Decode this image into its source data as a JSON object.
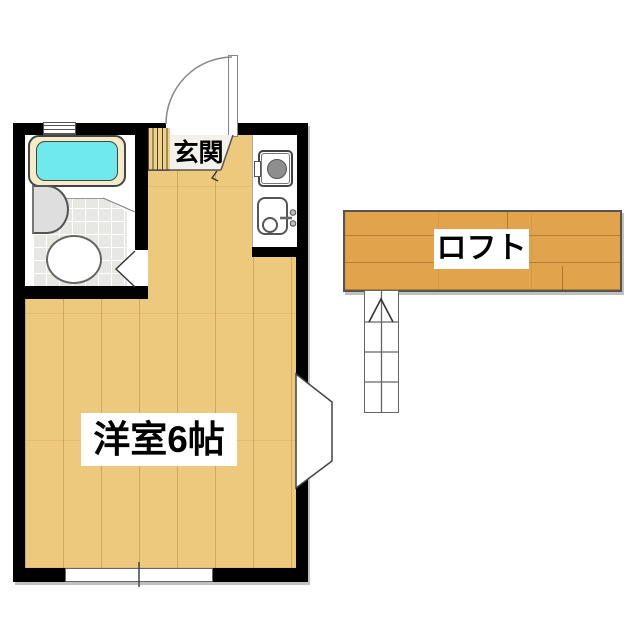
{
  "page": {
    "type": "floor-plan",
    "background": "#ffffff"
  },
  "labels": {
    "entrance": "玄関",
    "main_room": "洋室6帖",
    "loft": "ロフト"
  },
  "rooms": [
    {
      "name": "main-room",
      "label": "洋室6帖",
      "features": [
        "bay-window",
        "south-window"
      ]
    },
    {
      "name": "entrance",
      "label": "玄関",
      "features": [
        "entrance-door",
        "step"
      ]
    },
    {
      "name": "bathroom",
      "features": [
        "bathtub",
        "sink",
        "toilet",
        "vent"
      ]
    },
    {
      "name": "laundry-nook",
      "features": [
        "washing-machine",
        "wash-basin"
      ]
    },
    {
      "name": "loft",
      "label": "ロフト",
      "features": [
        "ladder"
      ]
    }
  ],
  "colors": {
    "wall": "#000000",
    "floor-wood": "#edc97e",
    "floor-seam": "#c9a257",
    "loft-wood": "#e1a44c",
    "step-wood": "#ecd28d",
    "concrete": "#f2f1ec",
    "tile": "#e7e7e3",
    "tub-rim": "#f6ebc8",
    "tub-water": "#70e9ec",
    "fixture-gray": "#dedede",
    "drum-gray": "#8e8e8e",
    "line-dark": "#444444",
    "line-mid": "#777777",
    "label-text": "#000000",
    "label-bg": "#ffffff"
  }
}
